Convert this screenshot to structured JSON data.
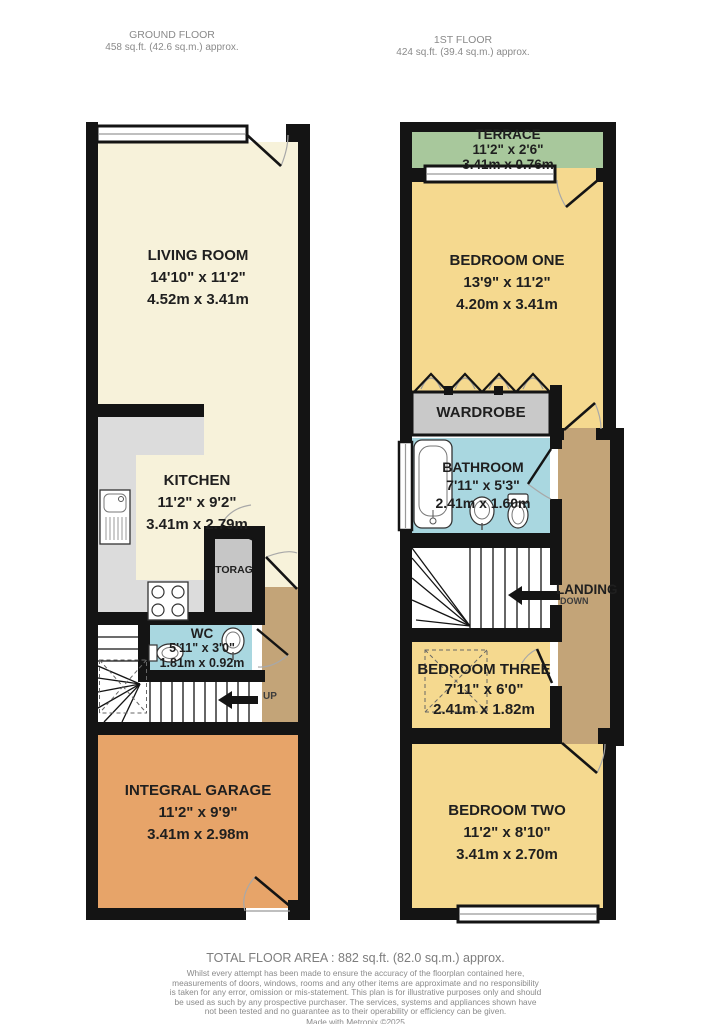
{
  "headers": {
    "ground_floor": {
      "title": "GROUND FLOOR",
      "area": "458 sq.ft. (42.6 sq.m.) approx."
    },
    "first_floor": {
      "title": "1ST FLOOR",
      "area": "424 sq.ft. (39.4 sq.m.) approx."
    }
  },
  "ground_floor": {
    "living_room": {
      "name": "LIVING ROOM",
      "imperial": "14'10\"  x 11'2\"",
      "metric": "4.52m  x 3.41m"
    },
    "kitchen": {
      "name": "KITCHEN",
      "imperial": "11'2\"  x 9'2\"",
      "metric": "3.41m  x 2.79m"
    },
    "storage": {
      "name": "STORAGE"
    },
    "wc": {
      "name": "WC",
      "imperial": "5'11\"  x 3'0\"",
      "metric": "1.81m  x 0.92m"
    },
    "garage": {
      "name": "INTEGRAL GARAGE",
      "imperial": "11'2\"  x 9'9\"",
      "metric": "3.41m  x 2.98m"
    },
    "stairs_label": "UP"
  },
  "first_floor": {
    "terrace": {
      "name": "TERRACE",
      "imperial": "11'2\"  x 2'6\"",
      "metric": "3.41m  x 0.76m"
    },
    "bedroom_one": {
      "name": "BEDROOM ONE",
      "imperial": "13'9\"  x 11'2\"",
      "metric": "4.20m  x 3.41m"
    },
    "wardrobe": {
      "name": "WARDROBE"
    },
    "bathroom": {
      "name": "BATHROOM",
      "imperial": "7'11\"  x 5'3\"",
      "metric": "2.41m  x 1.60m"
    },
    "landing": {
      "name": "LANDING",
      "direction": "DOWN"
    },
    "bedroom_three": {
      "name": "BEDROOM THREE",
      "imperial": "7'11\"  x 6'0\"",
      "metric": "2.41m  x 1.82m"
    },
    "bedroom_two": {
      "name": "BEDROOM TWO",
      "imperial": "11'2\"  x 8'10\"",
      "metric": "3.41m  x 2.70m"
    }
  },
  "footer": {
    "total_area": "TOTAL FLOOR AREA : 882 sq.ft. (82.0 sq.m.) approx.",
    "disclaimer": "Whilst every attempt has been made to ensure the accuracy of the floorplan contained here, measurements of doors, windows, rooms and any other items are approximate and no responsibility is taken for any error, omission or mis-statement. This plan is for illustrative purposes only and should be used as such by any prospective purchaser. The services, systems and appliances shown have not been tested and no guarantee as to their operability or efficiency can be given.",
    "credit": "Made with Metropix ©2025"
  },
  "colors": {
    "wall": "#141414",
    "room_cream": "#f7f2da",
    "room_yellow": "#f5d98f",
    "terrace_green": "#a8c89c",
    "wet_room_blue": "#a9d7e0",
    "hall_tan": "#c3a478",
    "garage_orange": "#e7a469",
    "counter_gray": "#dcdcdc",
    "storage_gray": "#c6c6c6",
    "wardrobe_gray": "#c9c9c9"
  }
}
